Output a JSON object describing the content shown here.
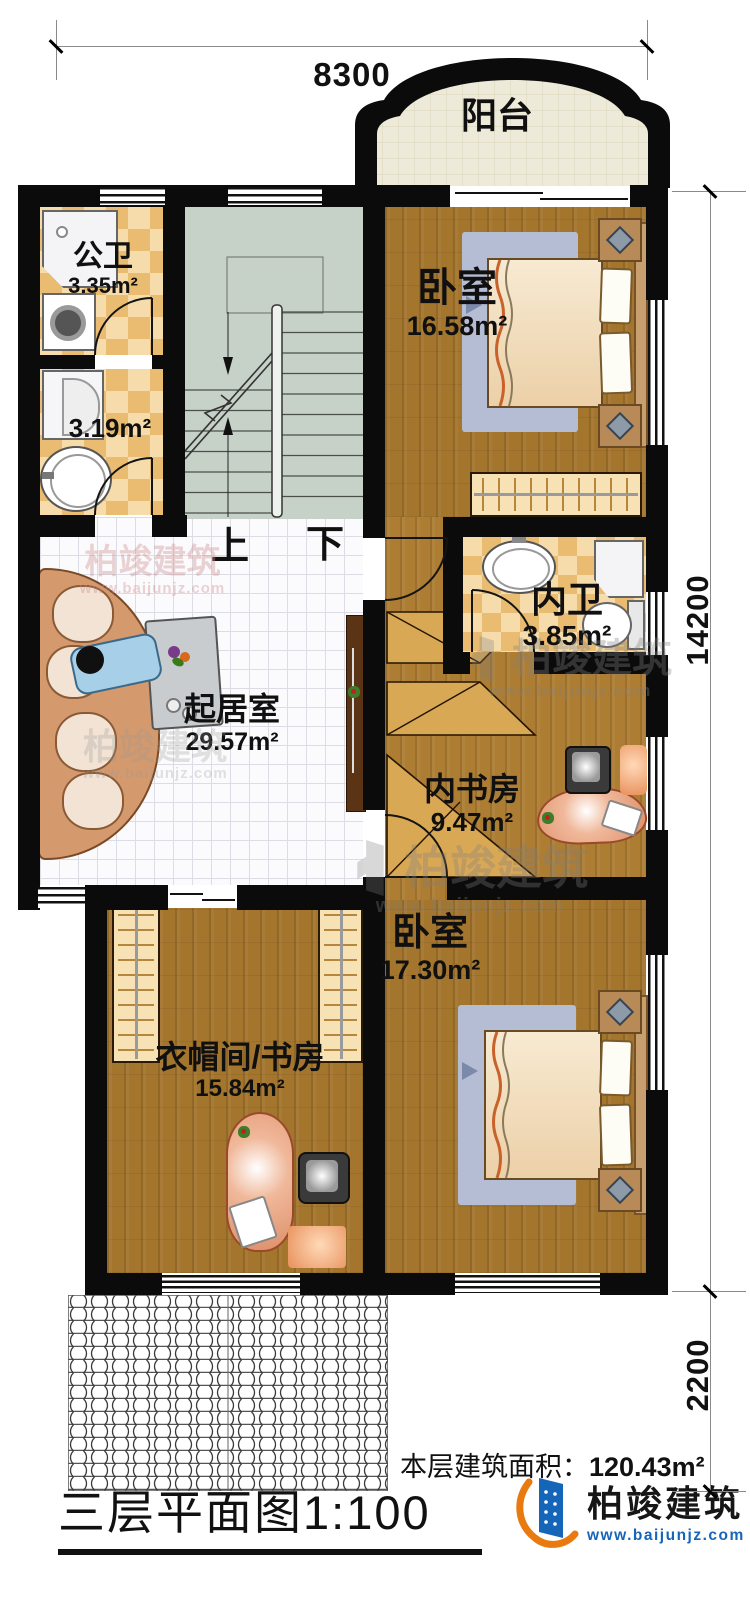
{
  "plan_title": "三层平面图1:100",
  "floor_note": {
    "label": "本层建筑面积：",
    "value": "120.43m²"
  },
  "dimensions": {
    "width_top": "8300",
    "height_right": "14200",
    "height_lower_right": "2200"
  },
  "rooms": {
    "balcony": {
      "name": "阳台"
    },
    "public_bath": {
      "name": "公卫",
      "area": "3.35m²"
    },
    "bath_small": {
      "area": "3.19m²"
    },
    "bedroom_top": {
      "name": "卧室",
      "area": "16.58m²"
    },
    "inner_bath": {
      "name": "内卫",
      "area": "3.85m²"
    },
    "living_room": {
      "name": "起居室",
      "area": "29.57m²"
    },
    "inner_study": {
      "name": "内书房",
      "area": "9.47m²"
    },
    "bedroom_bottom": {
      "name": "卧室",
      "area": "17.30m²"
    },
    "cloakroom_study": {
      "name": "衣帽间/书房",
      "area": "15.84m²"
    }
  },
  "stairs": {
    "up_label": "上",
    "down_label": "下"
  },
  "brand": {
    "name": "柏竣建筑",
    "url": "www.baijunjz.com"
  },
  "colors": {
    "wall": "#0b0b0b",
    "wood_floor": "#a3752d",
    "living_tile": "#fbfbfd",
    "stair_floor": "#c6d1c8",
    "checker_dark": "#e9bc72",
    "checker_light": "#f6dcab",
    "balcony_floor": "#eeeada",
    "desk_salmon": "#e8a88a",
    "logo_blue": "#1565b8",
    "logo_orange": "#e87a10"
  }
}
